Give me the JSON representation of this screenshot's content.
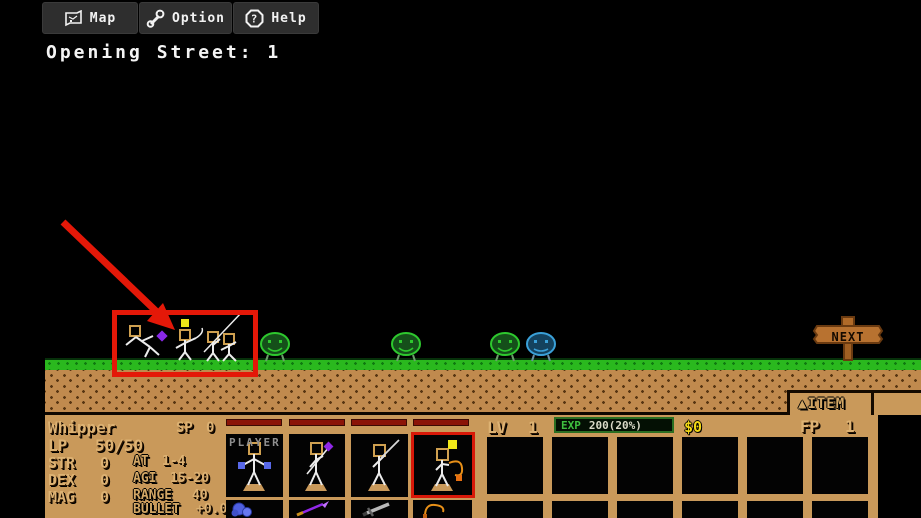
{
  "colors": {
    "accent_red": "#e41808",
    "panel_tan": "#c9995a",
    "grass_green": "#2ab81e",
    "exp_green": "#3fbf3f",
    "money_yellow": "#f2d714",
    "lp_bar_red": "#8b1408"
  },
  "toolbar": {
    "map_label": "Map",
    "option_label": "Option",
    "help_label": "Help",
    "help_icon": "?"
  },
  "stage": {
    "title": "Opening Street: 1"
  },
  "scene": {
    "next_sign_label": "NEXT",
    "enemies": [
      {
        "icon": "green-smiley-walker"
      },
      {
        "icon": "green-smiley-walker"
      },
      {
        "icon": "green-smiley-walker"
      },
      {
        "icon": "blue-smiley-walker"
      }
    ]
  },
  "status": {
    "name": "Whipper",
    "sp_label": "SP",
    "sp_value": "0",
    "lp_label": "LP",
    "lp_value": "50/50",
    "str_label": "STR",
    "str_value": "0",
    "dex_label": "DEX",
    "dex_value": "0",
    "mag_label": "MAG",
    "mag_value": "0",
    "at_label": "AT",
    "at_value": "1-4",
    "agi_label": "AGI",
    "agi_value": "15-20",
    "range_label": "RANGE",
    "range_value": "40",
    "bullet_label": "BULLET",
    "bullet_value": "+0.0"
  },
  "party": {
    "player_label": "PLAYER",
    "slots": [
      {
        "figure": "boxer",
        "weapon_icon": "blue-fist"
      },
      {
        "figure": "spearman",
        "weapon_icon": "purple-spear"
      },
      {
        "figure": "gladiator",
        "weapon_icon": "gray-sword"
      },
      {
        "figure": "whipper",
        "weapon_icon": "orange-whip",
        "selected": true
      }
    ]
  },
  "resources": {
    "lv_label": "LV",
    "lv_value": "1",
    "exp_label": "EXP",
    "exp_value": "200(20%)",
    "money": "$0",
    "fp_label": "FP",
    "fp_value": "1"
  },
  "item_tab": {
    "arrow": "▲",
    "label": "ITEM"
  }
}
